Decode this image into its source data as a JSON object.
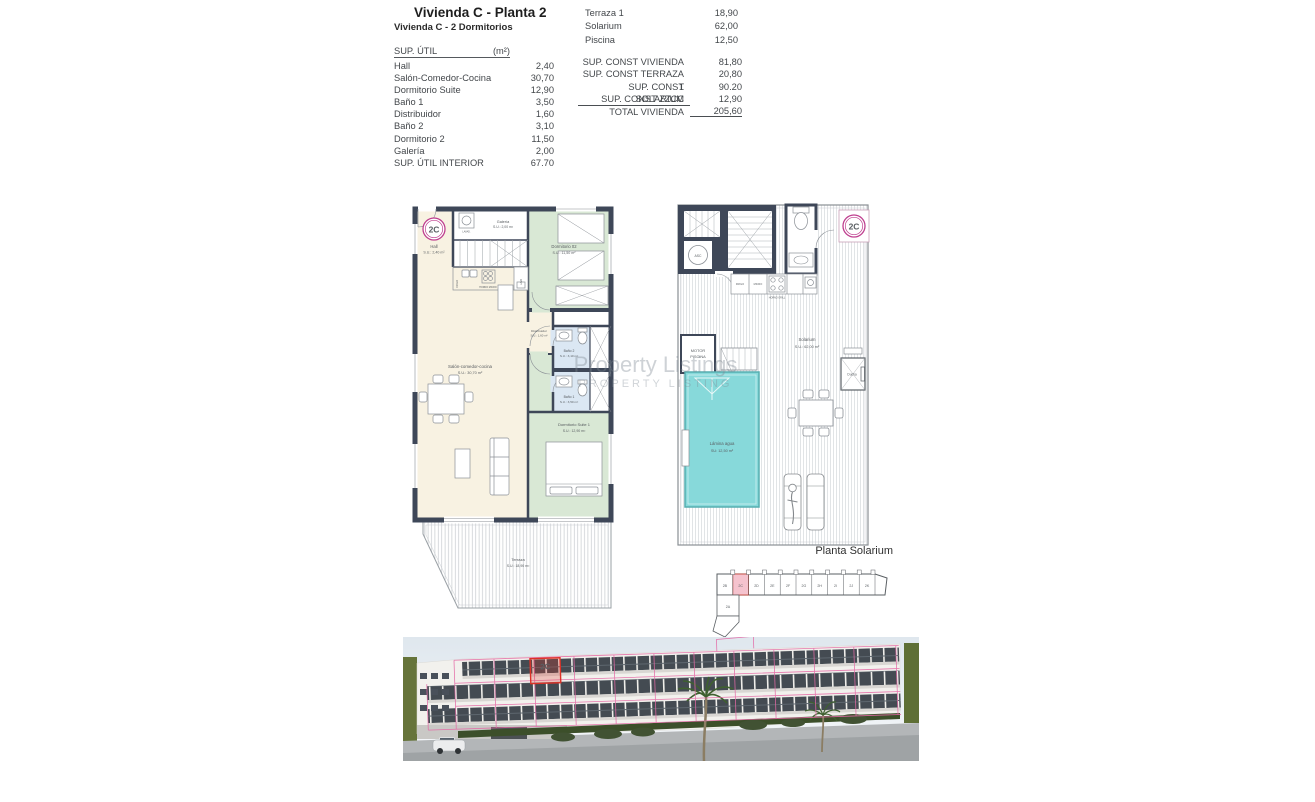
{
  "header": {
    "title": "Vivienda C - Planta 2",
    "subtitle": "Vivienda C - 2 Dormitorios"
  },
  "util_table": {
    "header_label": "SUP. ÚTIL",
    "header_unit": "(m²)",
    "rows": [
      {
        "label": "Hall",
        "value": "2,40"
      },
      {
        "label": "Salón-Comedor-Cocina",
        "value": "30,70"
      },
      {
        "label": "Dormitorio Suite",
        "value": "12,90"
      },
      {
        "label": "Baño 1",
        "value": "3,50"
      },
      {
        "label": "Distribuidor",
        "value": "1,60"
      },
      {
        "label": "Baño 2",
        "value": "3,10"
      },
      {
        "label": "Dormitorio 2",
        "value": "11,50"
      },
      {
        "label": "Galería",
        "value": "2,00"
      },
      {
        "label": "SUP. ÚTIL INTERIOR",
        "value": "67.70"
      }
    ]
  },
  "exterior_table": {
    "rows": [
      {
        "label": "Terraza 1",
        "value": "18,90"
      },
      {
        "label": "Solarium",
        "value": "62,00"
      },
      {
        "label": "Piscina",
        "value": "12,50"
      }
    ]
  },
  "const_table": {
    "rows": [
      {
        "label": "SUP. CONST VIVIENDA",
        "value": "81,80"
      },
      {
        "label": "SUP. CONST TERRAZA 1",
        "value": "20,80"
      },
      {
        "label": "SUP. CONST SOLARIUM",
        "value": "90.20"
      },
      {
        "label": "SUP. CONST ZZCC",
        "value": "12,90"
      }
    ],
    "total_label": "TOTAL VIVIENDA",
    "total_value": "205,60"
  },
  "plan2": {
    "unit_badge": "2C",
    "hall_name": "Hall",
    "hall_area": "S.U.: 2,40 m²",
    "galeria_name": "Galería",
    "galeria_area": "S.U.: 2,00 m²",
    "lavad_label": "LAVAD.",
    "dorm2_name": "Dormitorio 02",
    "dorm2_area": "S.U.: 11,50 m²",
    "salon_name": "Salón-comedor-cocina",
    "salon_area": "S.U.: 30,70 m²",
    "distribuidor_name": "Distribuidor",
    "distribuidor_area": "S.U.: 1,60 m²",
    "bano2_name": "Baño 2",
    "bano2_area": "S.U.: 3,10 m²",
    "bano1_name": "Baño 1",
    "bano1_area": "S.U.: 3,50 m²",
    "suite_name": "Dormitorio Suite 1",
    "suite_area": "S.U.: 12,90 m²",
    "terraza_name": "Terraza",
    "terraza_area": "S.U.: 18,90 m²",
    "frigo_label": "FRIGO",
    "horno_label": "HORNO MICRO",
    "lava_label": "LAVA"
  },
  "solarium": {
    "unit_badge": "2C",
    "asc_label": "ASC",
    "motor_line1": "MOTOR",
    "motor_line2": "PISCINA",
    "solarium_name": "Solarium",
    "solarium_area": "S.U.: 62,00 m²",
    "pool_name": "Lámina agua",
    "pool_area": "SU:  12,50 m²",
    "ducha_label": "Ducha",
    "frigo_label": "FRIGO",
    "micro_label": "MICRO",
    "horno_label": "HORNO GRILL"
  },
  "key_plan": {
    "title": "Planta Solarium",
    "units": [
      "2B",
      "2C",
      "2D",
      "2E",
      "2F",
      "2G",
      "2H",
      "2I",
      "2J",
      "2K"
    ],
    "side_unit": "2A"
  },
  "render_view": {
    "unit_label": "2C"
  },
  "watermark": {
    "line1": "Property Listings",
    "line2": "PROPERTY LISTING"
  },
  "colors": {
    "wall": "#3e4758",
    "bedroom_green": "#d9e8d5",
    "living_cream": "#f8f2e2",
    "bath_blue": "#dbe7f3",
    "pool_cyan": "#87d9da",
    "badge_magenta": "#bf3f8f",
    "highlight_red": "#e03328",
    "overlay_pink": "#e06aa8",
    "keyplan_pink": "#f5c3ce"
  }
}
